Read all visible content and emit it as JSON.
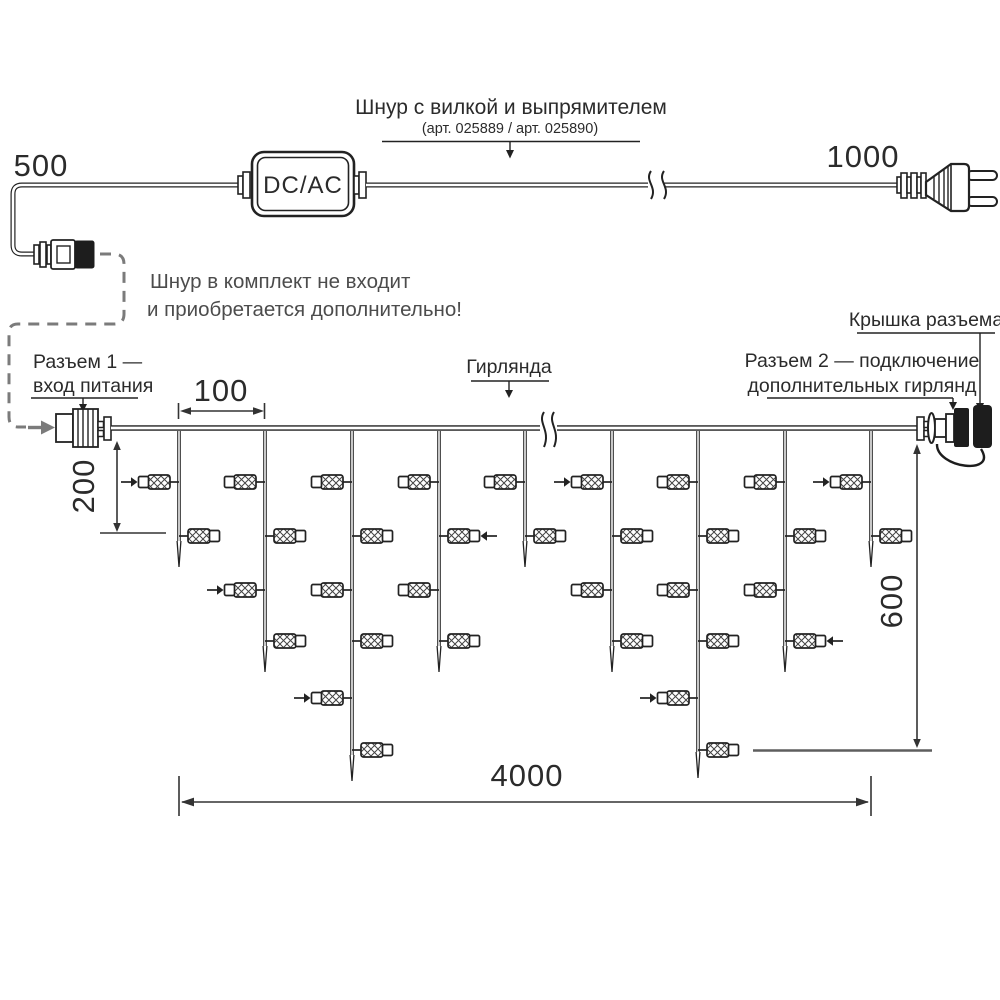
{
  "diagram": {
    "cord_label": {
      "title": "Шнур с вилкой и выпрямителем",
      "subtitle": "(арт. 025889 / арт. 025890)"
    },
    "note": {
      "line1": "Шнур в комплект не входит",
      "line2": "и приобретается дополнительно!"
    },
    "adapter": {
      "label": "DC/AC"
    },
    "connector1": {
      "line1": "Разъем 1 —",
      "line2": "вход питания"
    },
    "connector2": {
      "line1": "Разъем 2 — подключение",
      "line2": "дополнительных гирлянд"
    },
    "cap_label": "Крышка разъема",
    "garland_label": "Гирлянда",
    "dimensions": {
      "cord_left": "500",
      "cord_right": "1000",
      "drop_spacing": "100",
      "first_drop_offset": "200",
      "curtain_height": "600",
      "curtain_width": "4000"
    },
    "colors": {
      "line": "#222222",
      "gray_text": "#4c4c4c",
      "dashed": "#7b7b7b",
      "tick_gray": "#5e5e5e"
    },
    "garland": {
      "wire_y": 428,
      "lamp_levels": [
        482,
        536,
        590,
        641,
        698,
        750
      ],
      "drops": [
        {
          "x": 179,
          "tip": 567,
          "lamps": [
            {
              "level": 1,
              "side": "left",
              "arrow": true
            },
            {
              "level": 2,
              "side": "right",
              "arrow": false
            }
          ]
        },
        {
          "x": 265,
          "tip": 672,
          "lamps": [
            {
              "level": 1,
              "side": "left",
              "arrow": false
            },
            {
              "level": 2,
              "side": "right",
              "arrow": false
            },
            {
              "level": 3,
              "side": "left",
              "arrow": true
            },
            {
              "level": 4,
              "side": "right",
              "arrow": false
            }
          ]
        },
        {
          "x": 352,
          "tip": 781,
          "lamps": [
            {
              "level": 1,
              "side": "left",
              "arrow": false
            },
            {
              "level": 2,
              "side": "right",
              "arrow": false
            },
            {
              "level": 3,
              "side": "left",
              "arrow": false
            },
            {
              "level": 4,
              "side": "right",
              "arrow": false
            },
            {
              "level": 5,
              "side": "left",
              "arrow": true
            },
            {
              "level": 6,
              "side": "right",
              "arrow": false
            }
          ]
        },
        {
          "x": 439,
          "tip": 672,
          "lamps": [
            {
              "level": 1,
              "side": "left",
              "arrow": false
            },
            {
              "level": 2,
              "side": "right",
              "arrow": true
            },
            {
              "level": 3,
              "side": "left",
              "arrow": false
            },
            {
              "level": 4,
              "side": "right",
              "arrow": false
            }
          ]
        },
        {
          "x": 525,
          "tip": 567,
          "lamps": [
            {
              "level": 1,
              "side": "left",
              "arrow": false
            },
            {
              "level": 2,
              "side": "right",
              "arrow": false
            }
          ]
        },
        {
          "x": 612,
          "tip": 672,
          "lamps": [
            {
              "level": 1,
              "side": "left",
              "arrow": true
            },
            {
              "level": 2,
              "side": "right",
              "arrow": false
            },
            {
              "level": 3,
              "side": "left",
              "arrow": false
            },
            {
              "level": 4,
              "side": "right",
              "arrow": false
            }
          ]
        },
        {
          "x": 698,
          "tip": 778,
          "lamps": [
            {
              "level": 1,
              "side": "left",
              "arrow": false
            },
            {
              "level": 2,
              "side": "right",
              "arrow": false
            },
            {
              "level": 3,
              "side": "left",
              "arrow": false
            },
            {
              "level": 4,
              "side": "right",
              "arrow": false
            },
            {
              "level": 5,
              "side": "left",
              "arrow": true
            },
            {
              "level": 6,
              "side": "right",
              "arrow": false
            }
          ]
        },
        {
          "x": 785,
          "tip": 672,
          "lamps": [
            {
              "level": 1,
              "side": "left",
              "arrow": false
            },
            {
              "level": 2,
              "side": "right",
              "arrow": false
            },
            {
              "level": 3,
              "side": "left",
              "arrow": false
            },
            {
              "level": 4,
              "side": "right",
              "arrow": true
            }
          ]
        },
        {
          "x": 871,
          "tip": 567,
          "lamps": [
            {
              "level": 1,
              "side": "left",
              "arrow": true
            },
            {
              "level": 2,
              "side": "right",
              "arrow": false
            }
          ]
        }
      ]
    }
  }
}
